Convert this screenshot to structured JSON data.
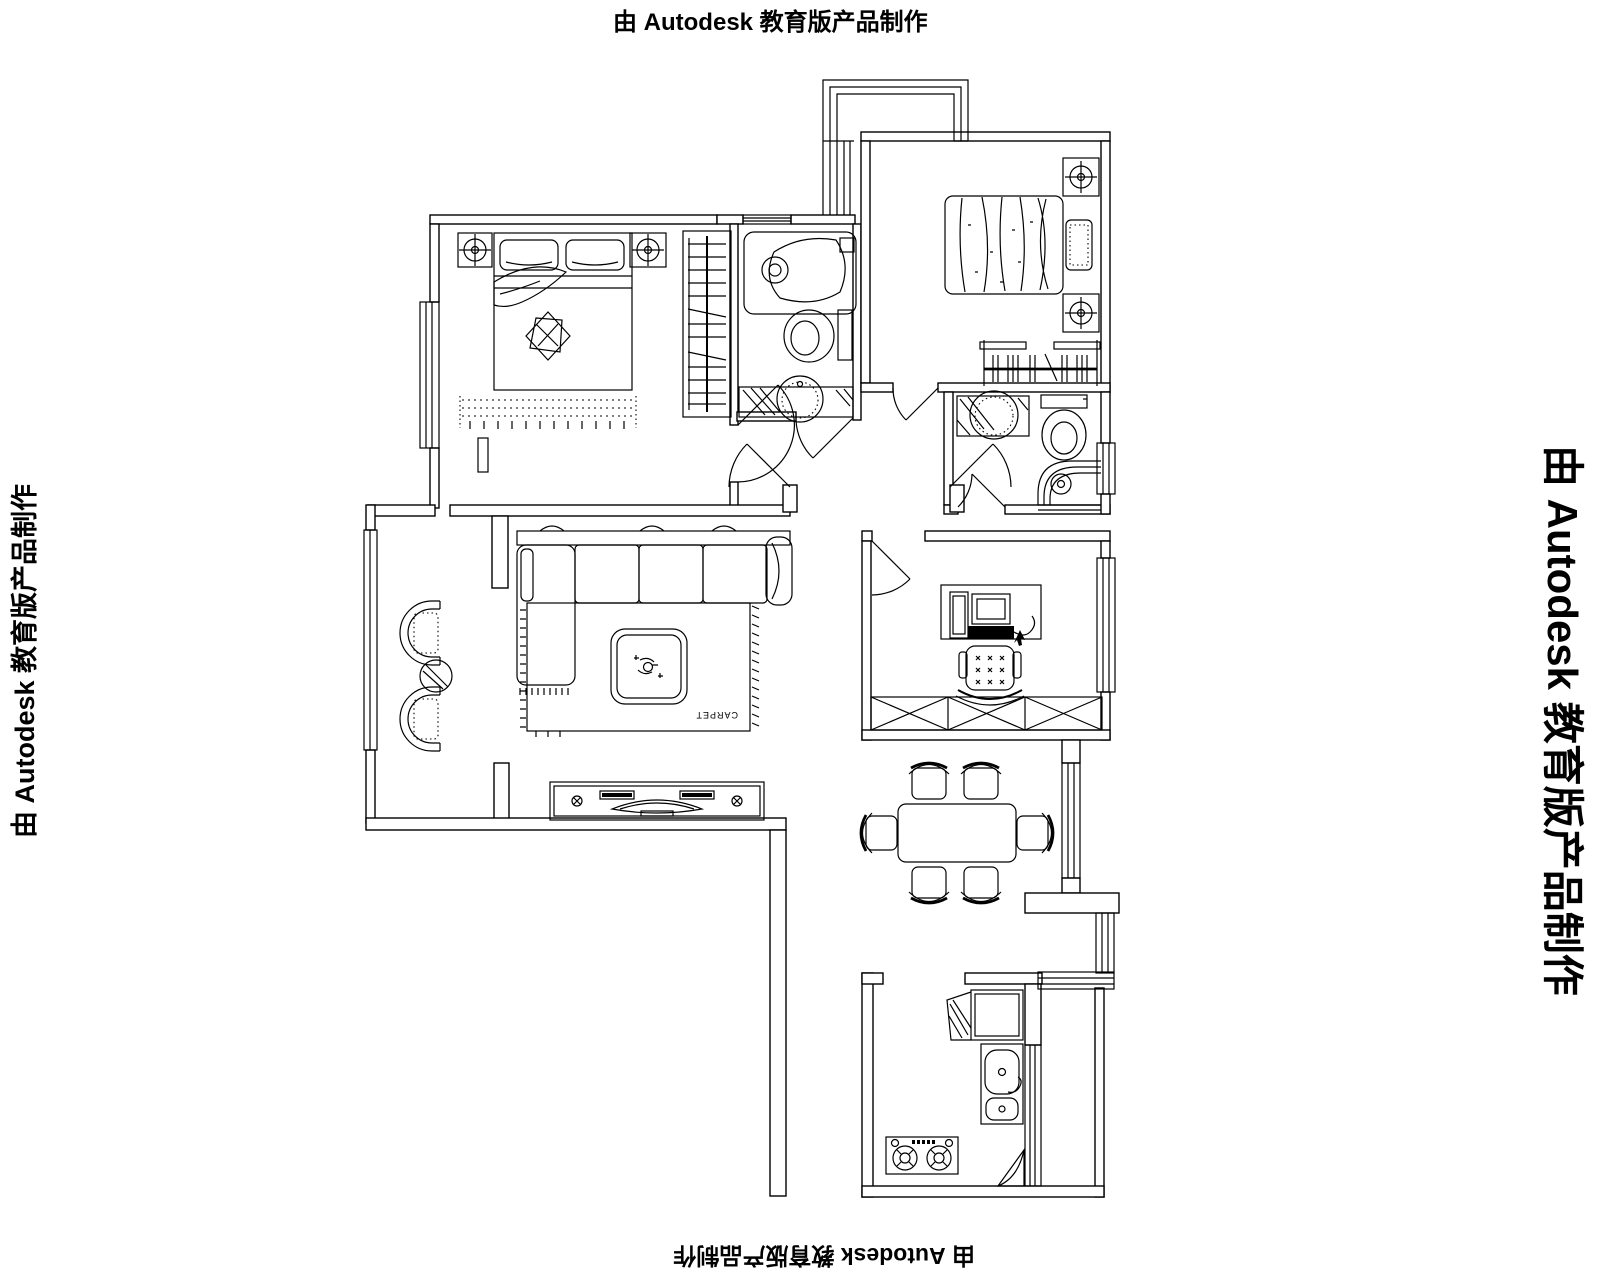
{
  "drawing": {
    "kind": "apartment floor plan (CAD line drawing)",
    "line_color": "#000000",
    "background_color": "#ffffff"
  },
  "watermarks": {
    "top": "由 Autodesk 教育版产品制作",
    "right": "由 Autodesk 教育版产品制作",
    "bottom": "由 Autodesk 教育版产品制作",
    "left": "由 Autodesk 教育版产品制作"
  },
  "labels": {
    "carpet": "CARPET"
  },
  "rooms": [
    {
      "id": "master-bedroom",
      "furniture": [
        "double-bed",
        "two-pillows",
        "nightstands-with-lamps",
        "wardrobe-with-hangers",
        "rug",
        "left-window"
      ]
    },
    {
      "id": "main-bathroom",
      "furniture": [
        "bathtub",
        "toilet",
        "round-basin-on-counter",
        "top-window"
      ]
    },
    {
      "id": "second-bedroom",
      "furniture": [
        "bed-with-quilt",
        "pillow",
        "nightstands-with-lamps",
        "clothes-rail-with-hangers"
      ]
    },
    {
      "id": "ensuite-bathroom",
      "furniture": [
        "basin-on-counter",
        "toilet",
        "corner-bathtub",
        "right-window"
      ]
    },
    {
      "id": "hallway",
      "furniture": [
        "door-swings"
      ]
    },
    {
      "id": "living-room",
      "furniture": [
        "l-shaped-sofa",
        "coffee-table",
        "carpet-rug",
        "tv-cabinet"
      ]
    },
    {
      "id": "lounge-balcony",
      "furniture": [
        "two-armchairs",
        "round-side-table",
        "left-window"
      ]
    },
    {
      "id": "study",
      "furniture": [
        "desk",
        "computer",
        "chair",
        "low-cabinet-x-boxes",
        "right-window"
      ]
    },
    {
      "id": "dining-room",
      "furniture": [
        "dining-table",
        "six-chairs",
        "right-window"
      ]
    },
    {
      "id": "kitchen",
      "furniture": [
        "refrigerator",
        "double-sink",
        "two-burner-stove",
        "corner-unit"
      ]
    }
  ]
}
